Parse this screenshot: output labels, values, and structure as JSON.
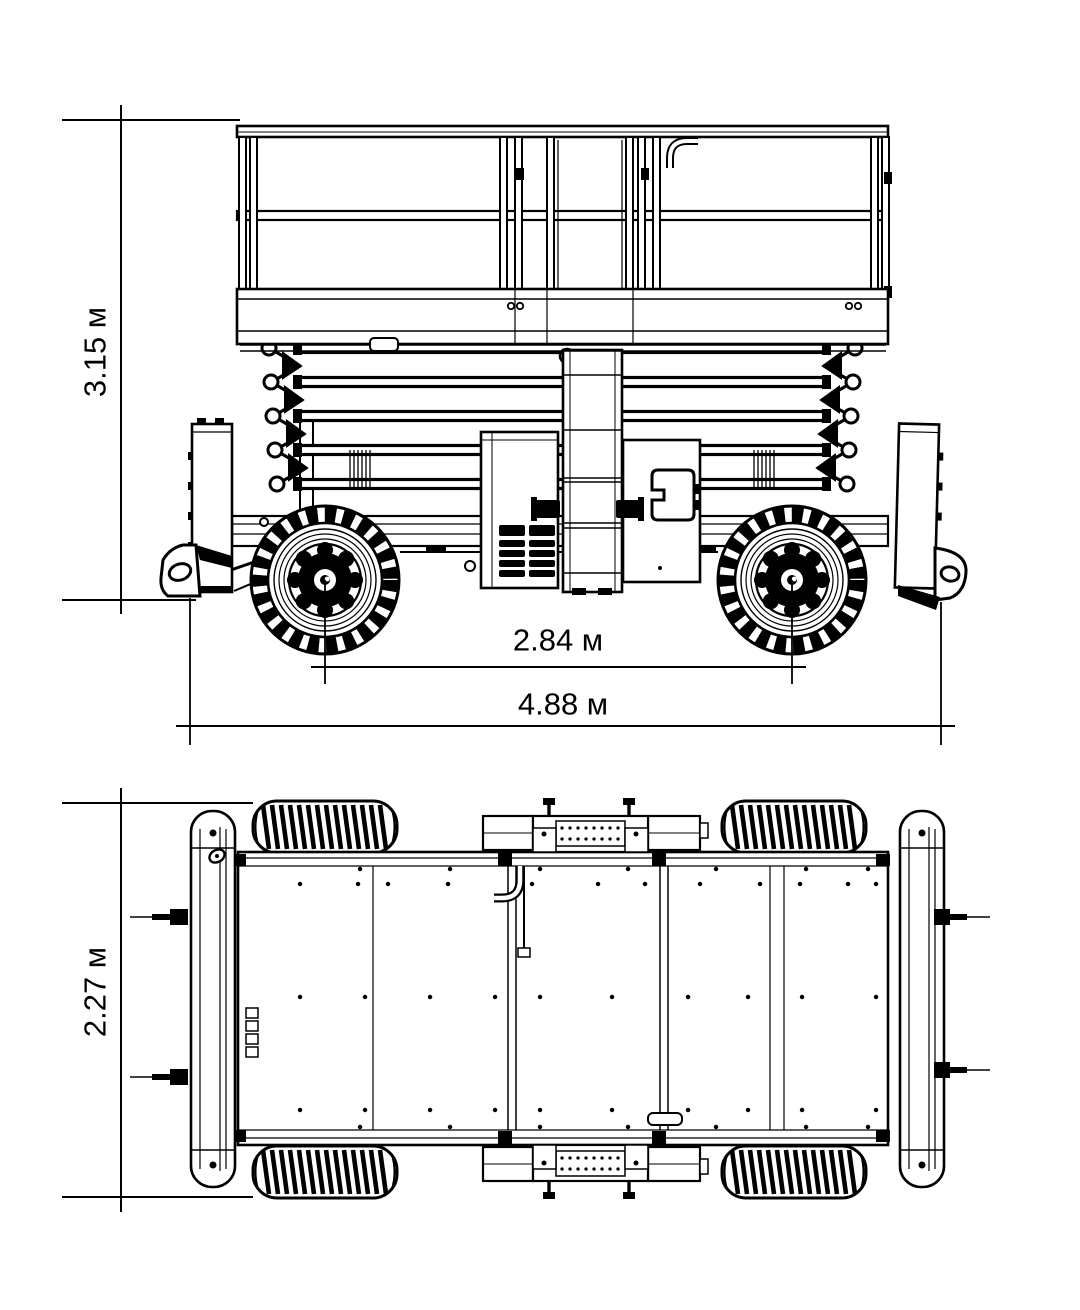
{
  "page": {
    "background": "#ffffff",
    "ink": "#000000"
  },
  "drawing": {
    "unit": "м",
    "side_view": {
      "height_label": "3.15 м",
      "wheelbase_label": "2.84 м",
      "length_label": "4.88 м"
    },
    "plan_view": {
      "width_label": "2.27 м"
    }
  }
}
